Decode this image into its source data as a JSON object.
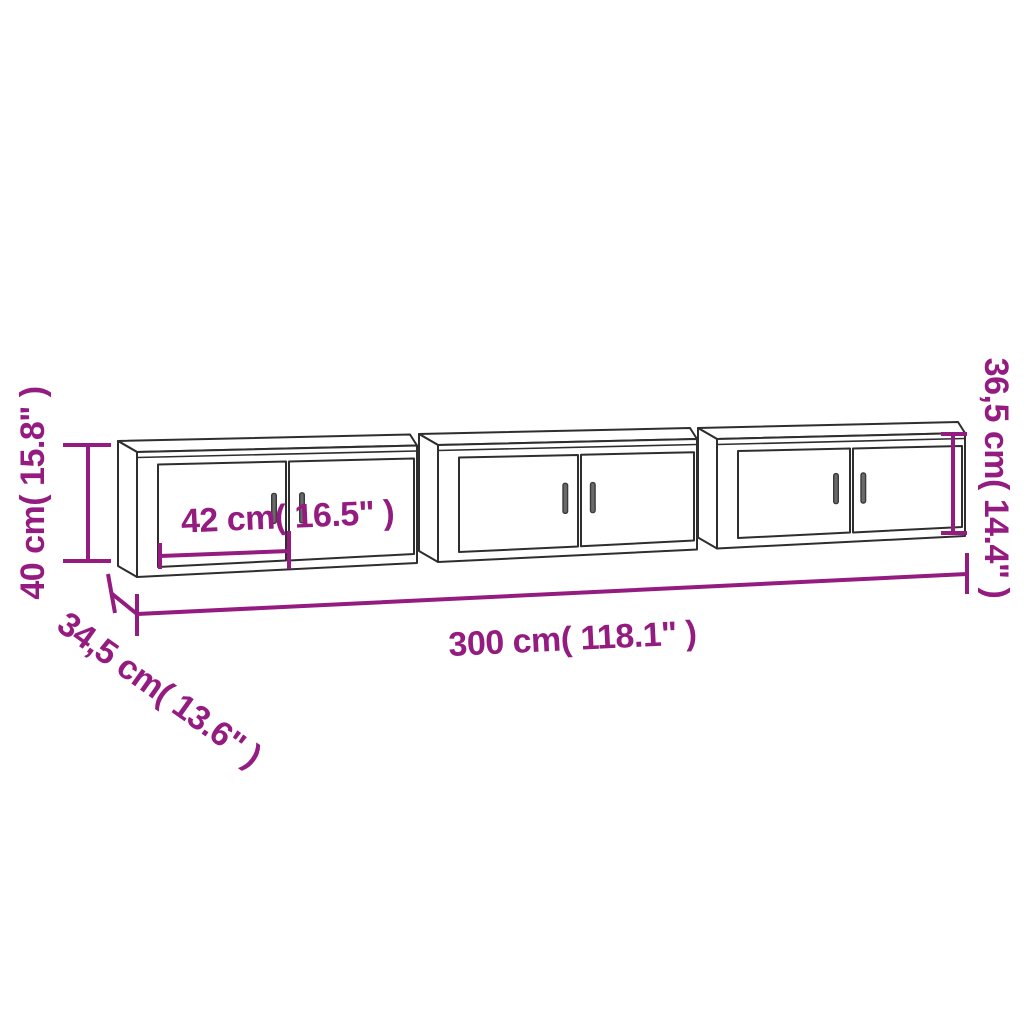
{
  "diagram": {
    "subject": "Three wall-mounted TV cabinets, each with two doors",
    "colors": {
      "accent": "#941B80",
      "outline": "#2e2e2e",
      "background": "#ffffff"
    },
    "dimensions": {
      "overall_height": "40 cm( 15.8\" )",
      "depth": "34,5 cm( 13.6\" )",
      "overall_width": "300 cm( 118.1\" )",
      "cabinet_height": "36,5 cm( 14.4\" )",
      "door_width": "42 cm( 16.5\" )"
    }
  }
}
